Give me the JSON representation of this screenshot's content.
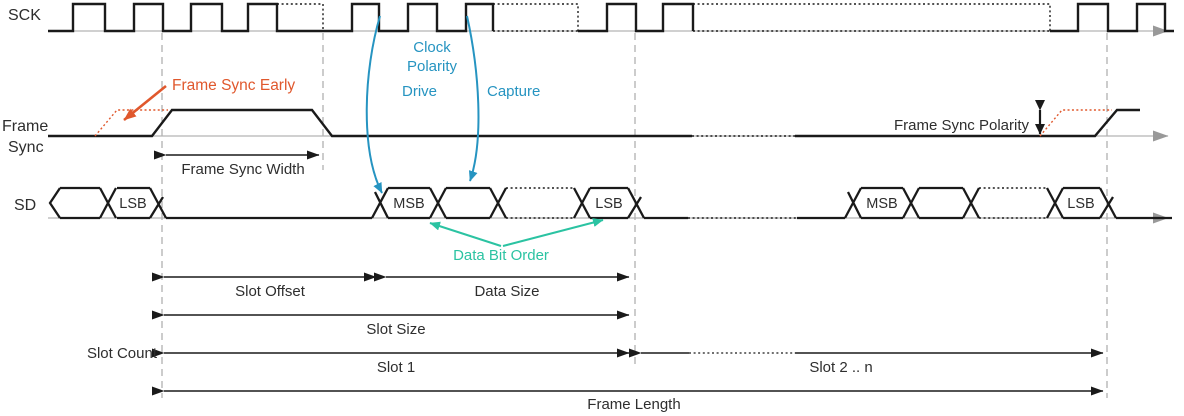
{
  "diagram": {
    "title_hint": "Serial audio interface frame timing diagram",
    "signals": {
      "sck": "SCK",
      "frame_sync_line1": "Frame",
      "frame_sync_line2": "Sync",
      "sd": "SD"
    },
    "annotations": {
      "frame_sync_early": "Frame Sync Early",
      "clock_polarity_line1": "Clock",
      "clock_polarity_line2": "Polarity",
      "drive": "Drive",
      "capture": "Capture",
      "frame_sync_polarity": "Frame Sync Polarity",
      "frame_sync_width": "Frame Sync Width",
      "data_bit_order": "Data Bit Order"
    },
    "dimensions": {
      "slot_offset": "Slot Offset",
      "data_size": "Data Size",
      "slot_size": "Slot Size",
      "slot_count": "Slot Count",
      "slot_1": "Slot 1",
      "slot_2_n": "Slot 2 .. n",
      "frame_length": "Frame Length"
    },
    "sd_cells": {
      "pre_lsb": "LSB",
      "slot1_msb": "MSB",
      "slot1_lsb": "LSB",
      "slot2_msb": "MSB",
      "slot2_lsb": "LSB"
    },
    "colors": {
      "waveform": "#1a1a1a",
      "accent_orange": "#e0582d",
      "accent_blue": "#2694c1",
      "accent_teal": "#2bc3a2",
      "guide_gray": "#999999",
      "baseline_gray": "#b3b3b3"
    }
  }
}
